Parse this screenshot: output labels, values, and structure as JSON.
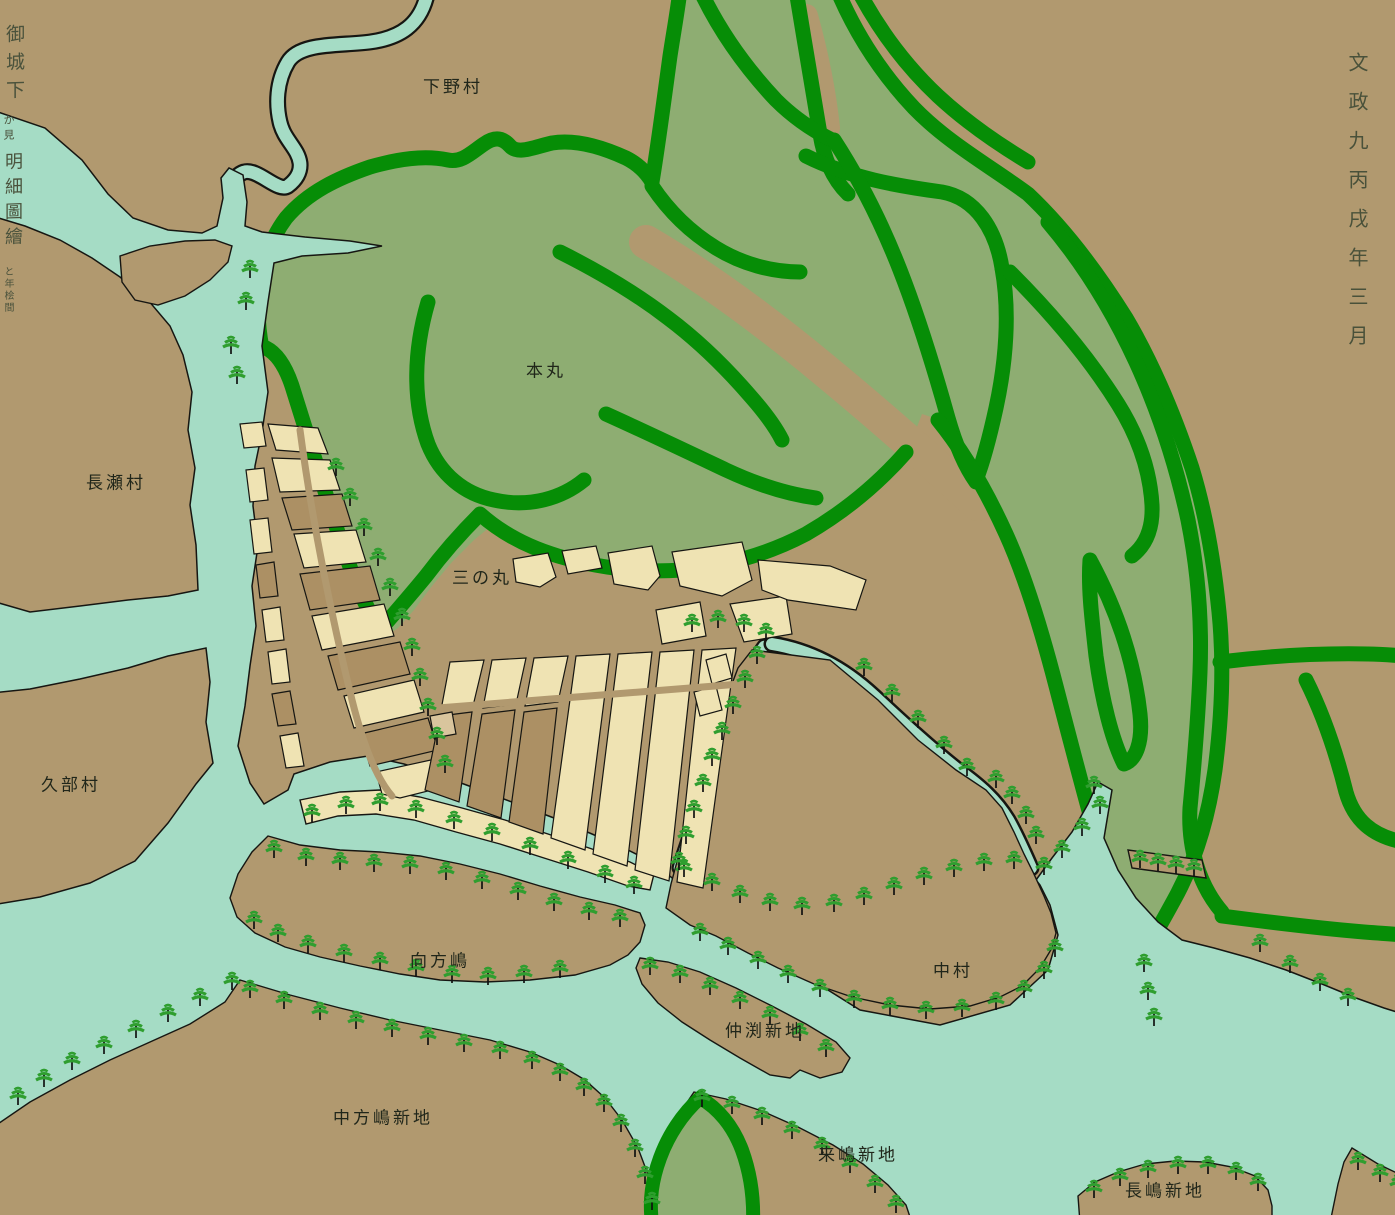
{
  "labels": {
    "shimono_mura": "下野村",
    "nagase_mura": "長瀬村",
    "kube_mura": "久部村",
    "honmaru": "本丸",
    "sannomaru": "三の丸",
    "mukaikatajima": "向方嶋",
    "nakamura": "中村",
    "nakabuchi_shinchi": "仲渕新地",
    "nakakatajima_shinchi": "中方嶋新地",
    "kurushima_shinchi": "来嶋新地",
    "nagashima_shinchi": "長嶋新地"
  },
  "inscription": {
    "date_column": "文政九丙戌年三月",
    "title_upper": "御城下",
    "title_note": "か見",
    "title_lower": "明細圖繪",
    "signature": "と年桧間"
  },
  "colors": {
    "land": "#b1996f",
    "water": "#a5dcc5",
    "hill_fill": "#8ead72",
    "ridge_green": "#068d06",
    "block_cream": "#efe3b3",
    "block_brown": "#ac9064",
    "block_accent": "#d9c59d",
    "outline": "#161612",
    "tree_green": "#2f9e2f",
    "label_text": "#20261a",
    "inscription_text": "#49513a"
  }
}
